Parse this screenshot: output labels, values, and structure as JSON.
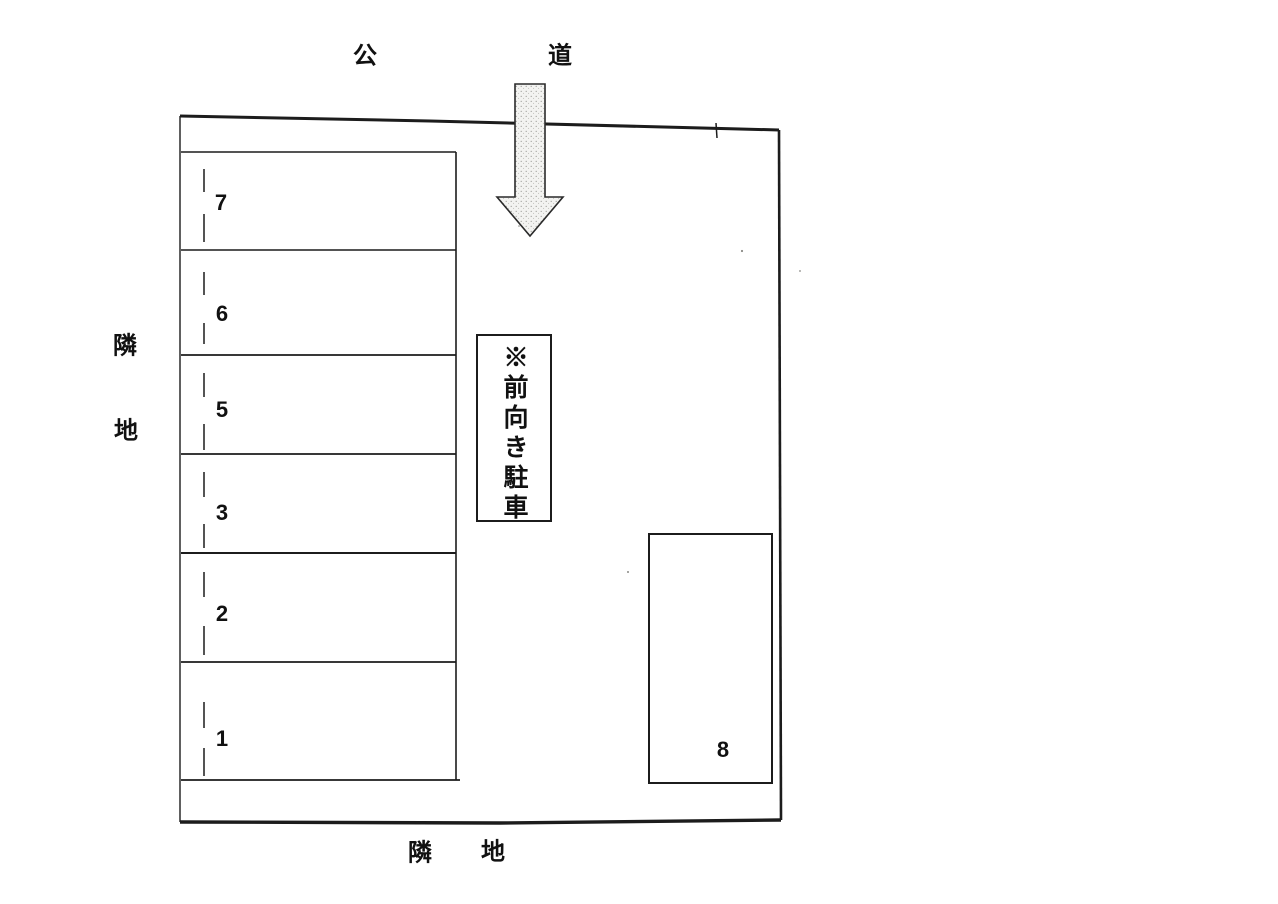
{
  "page": {
    "background": "#ffffff",
    "ink": "#1a1a1a"
  },
  "labels": {
    "road": {
      "full": "公道",
      "chars": [
        "公",
        "道"
      ]
    },
    "adjacent_left": {
      "full": "隣地",
      "chars": [
        "隣",
        "地"
      ]
    },
    "adjacent_bottom": {
      "full": "隣地",
      "chars": [
        "隣",
        "地"
      ]
    },
    "note": "※前向き駐車"
  },
  "parking": {
    "left_column_numbers": [
      "7",
      "6",
      "5",
      "3",
      "2",
      "1"
    ],
    "right_space_number": "8"
  },
  "icons": {
    "entrance_arrow": "down-block-arrow"
  }
}
